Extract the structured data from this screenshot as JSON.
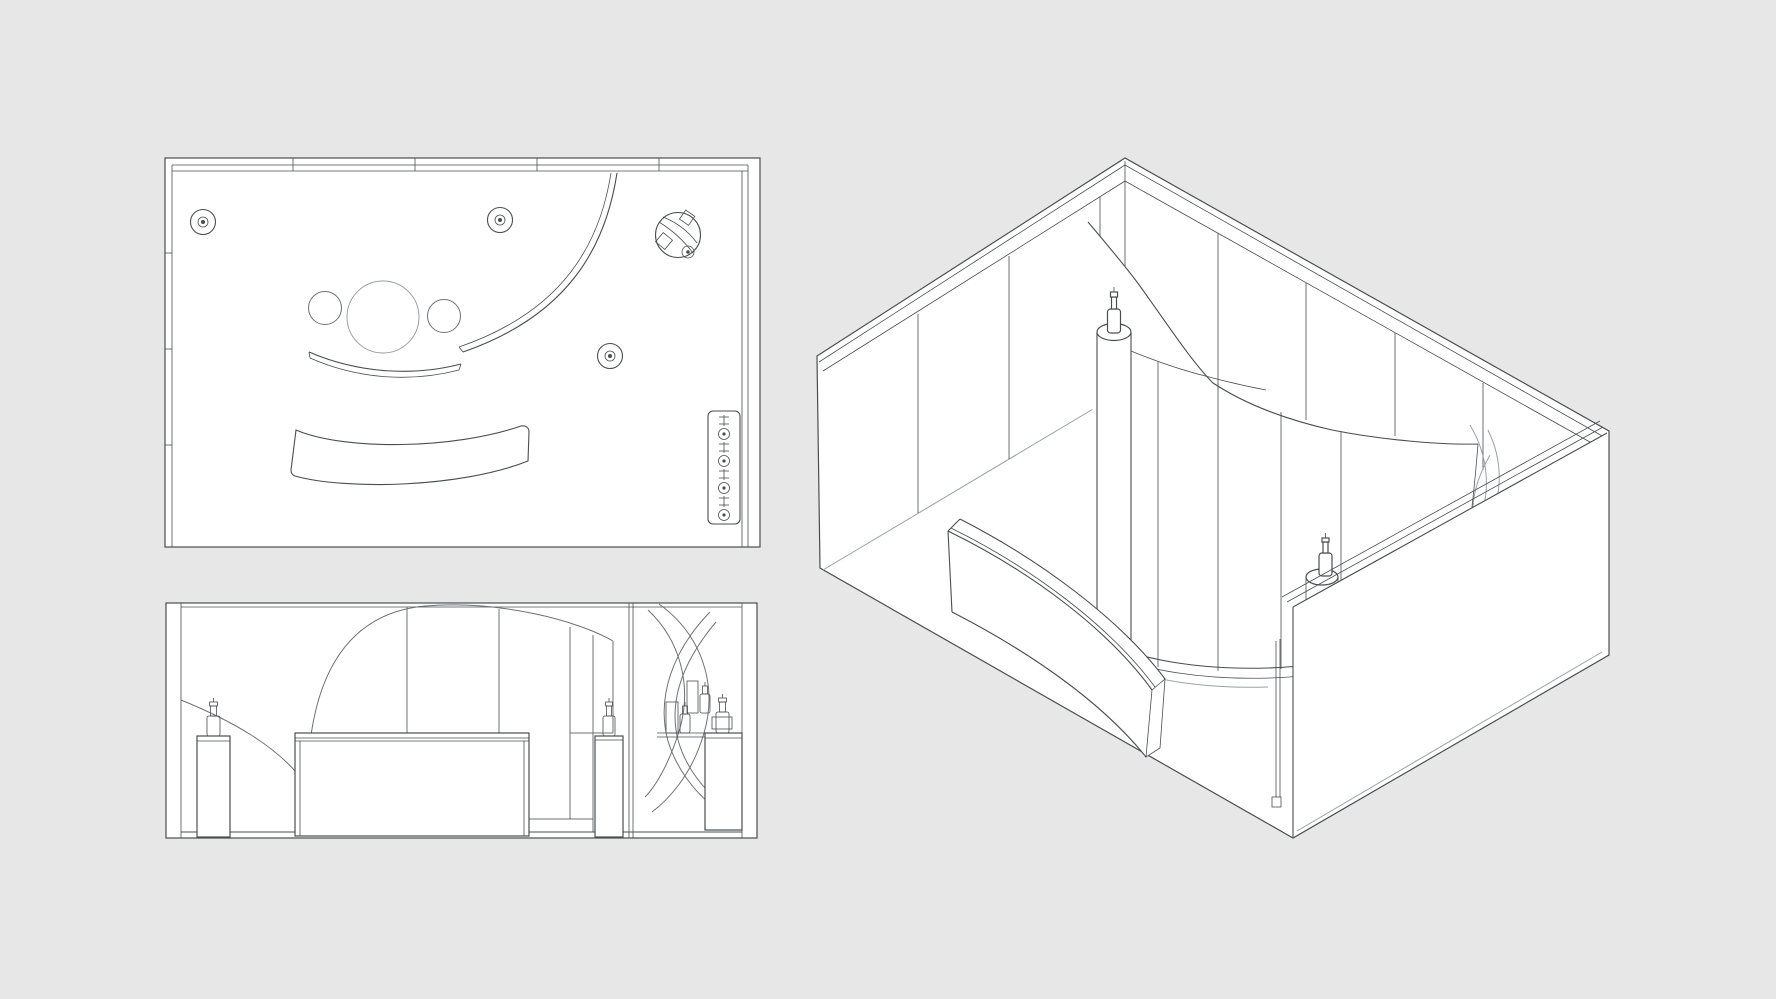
{
  "document": {
    "kind": "technical line drawing sheet",
    "subject": "exhibition booth / retail interior with curved wall, reception desk and display pedestals",
    "text_content": "none"
  },
  "canvas": {
    "width": 1776,
    "height": 999,
    "background_color": "#e7e7e8",
    "line_color": "#4a4d50",
    "light_line_color": "#9aa0a4",
    "paper_color": "#ffffff"
  },
  "views": {
    "floor_plan": {
      "label": "floor-plan-view",
      "spotlight_symbols": 4,
      "ceiling_circle_symbols": 3,
      "wall_shelf_items": 8,
      "features": [
        "perimeter walls",
        "large curved wall arc",
        "low curved wall",
        "curved reception desk",
        "spiral tower circle with diamonds",
        "wall shelf strip"
      ]
    },
    "elevation": {
      "label": "front-elevation-view",
      "pedestals": 3,
      "bottles": 5,
      "product_boxes": 2,
      "features": [
        "curved dome wall with seams",
        "reception desk",
        "left curved partition",
        "spiral display tower with shelf",
        "wall divider",
        "side panel and plinth"
      ]
    },
    "isometric": {
      "label": "isometric-view",
      "left_wall_panel_seams": 3,
      "right_wall_panel_seams": 4,
      "curved_wall_panel_seams": 4,
      "display_columns": 2,
      "bottles": 2,
      "features": [
        "three full-height walls",
        "open front edge",
        "curved sail wall",
        "curved reception desk",
        "cylindrical display column with bottle",
        "pedestal with bottle behind front wall",
        "spiral tower against right wall",
        "door frame strip at front corner"
      ]
    }
  }
}
